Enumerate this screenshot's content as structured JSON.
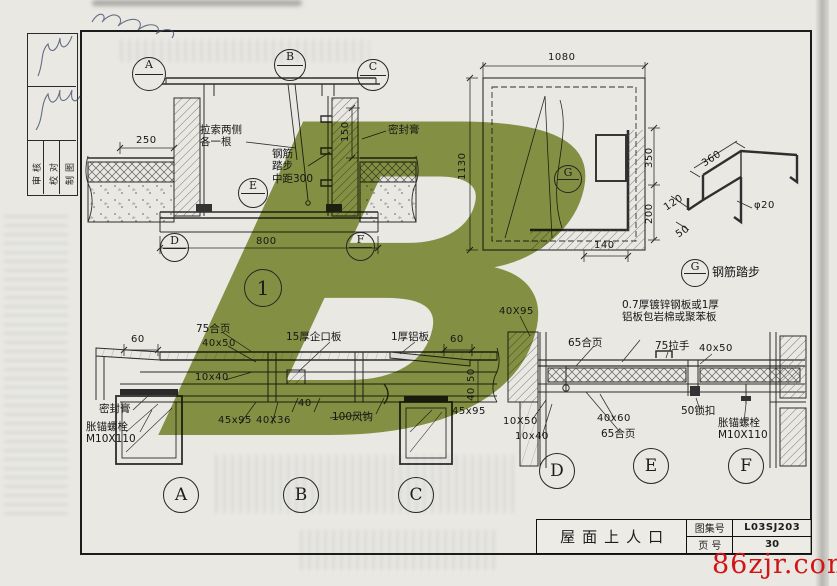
{
  "sheet": {
    "watermark_letter": "B",
    "watermark_color": "#87973d",
    "site_mark": "86zjr.com",
    "site_color": "#d21414"
  },
  "edge_table": {
    "labels": [
      "审核",
      "校对",
      "制图"
    ]
  },
  "detail_section": {
    "number": "1",
    "callouts": {
      "top": [
        "A",
        "B",
        "C"
      ],
      "mid": "E",
      "bottom": [
        "D",
        "F"
      ]
    },
    "labels": {
      "cable": "拉索两侧\n各一根",
      "steps": "钢筋\n踏步\n中距300",
      "sealant": "密封膏"
    },
    "dims": {
      "left": "250",
      "wall": "150",
      "bottom": "800"
    }
  },
  "plan": {
    "callout": "G",
    "dims": {
      "top": "1080",
      "left": "1130",
      "right_upper": "350",
      "right_lower": "200",
      "bottom": "140"
    }
  },
  "detail_g": {
    "callout": "G",
    "caption": "钢筋踏步",
    "dims": {
      "top": "360",
      "side": "120",
      "front": "50"
    },
    "diameter": "φ20"
  },
  "strip_left": {
    "callouts": [
      "A",
      "B",
      "C"
    ],
    "labels": [
      "60",
      "75合页",
      "40x50",
      "15厚企口板",
      "1厚铝板",
      "60",
      "10x40",
      "密封膏",
      "胀锚螺栓\nM10X110",
      "45x95",
      "40X36",
      "40",
      "100风钩",
      "45x95",
      "50",
      "40"
    ]
  },
  "strip_right": {
    "callouts": [
      "D",
      "E",
      "F"
    ],
    "labels": [
      "40X95",
      "0.7厚镀锌钢板或1厚\n铝板包岩棉或聚苯板",
      "65合页",
      "75拉手",
      "40x50",
      "10X50",
      "10x40",
      "40x60",
      "65合页",
      "50锁扣",
      "胀锚螺栓\nM10X110"
    ]
  },
  "title_block": {
    "title": "屋面上人口",
    "atlas_label": "图集号",
    "atlas_value": "L03SJ203",
    "page_label": "页 号",
    "page_value": "30"
  }
}
